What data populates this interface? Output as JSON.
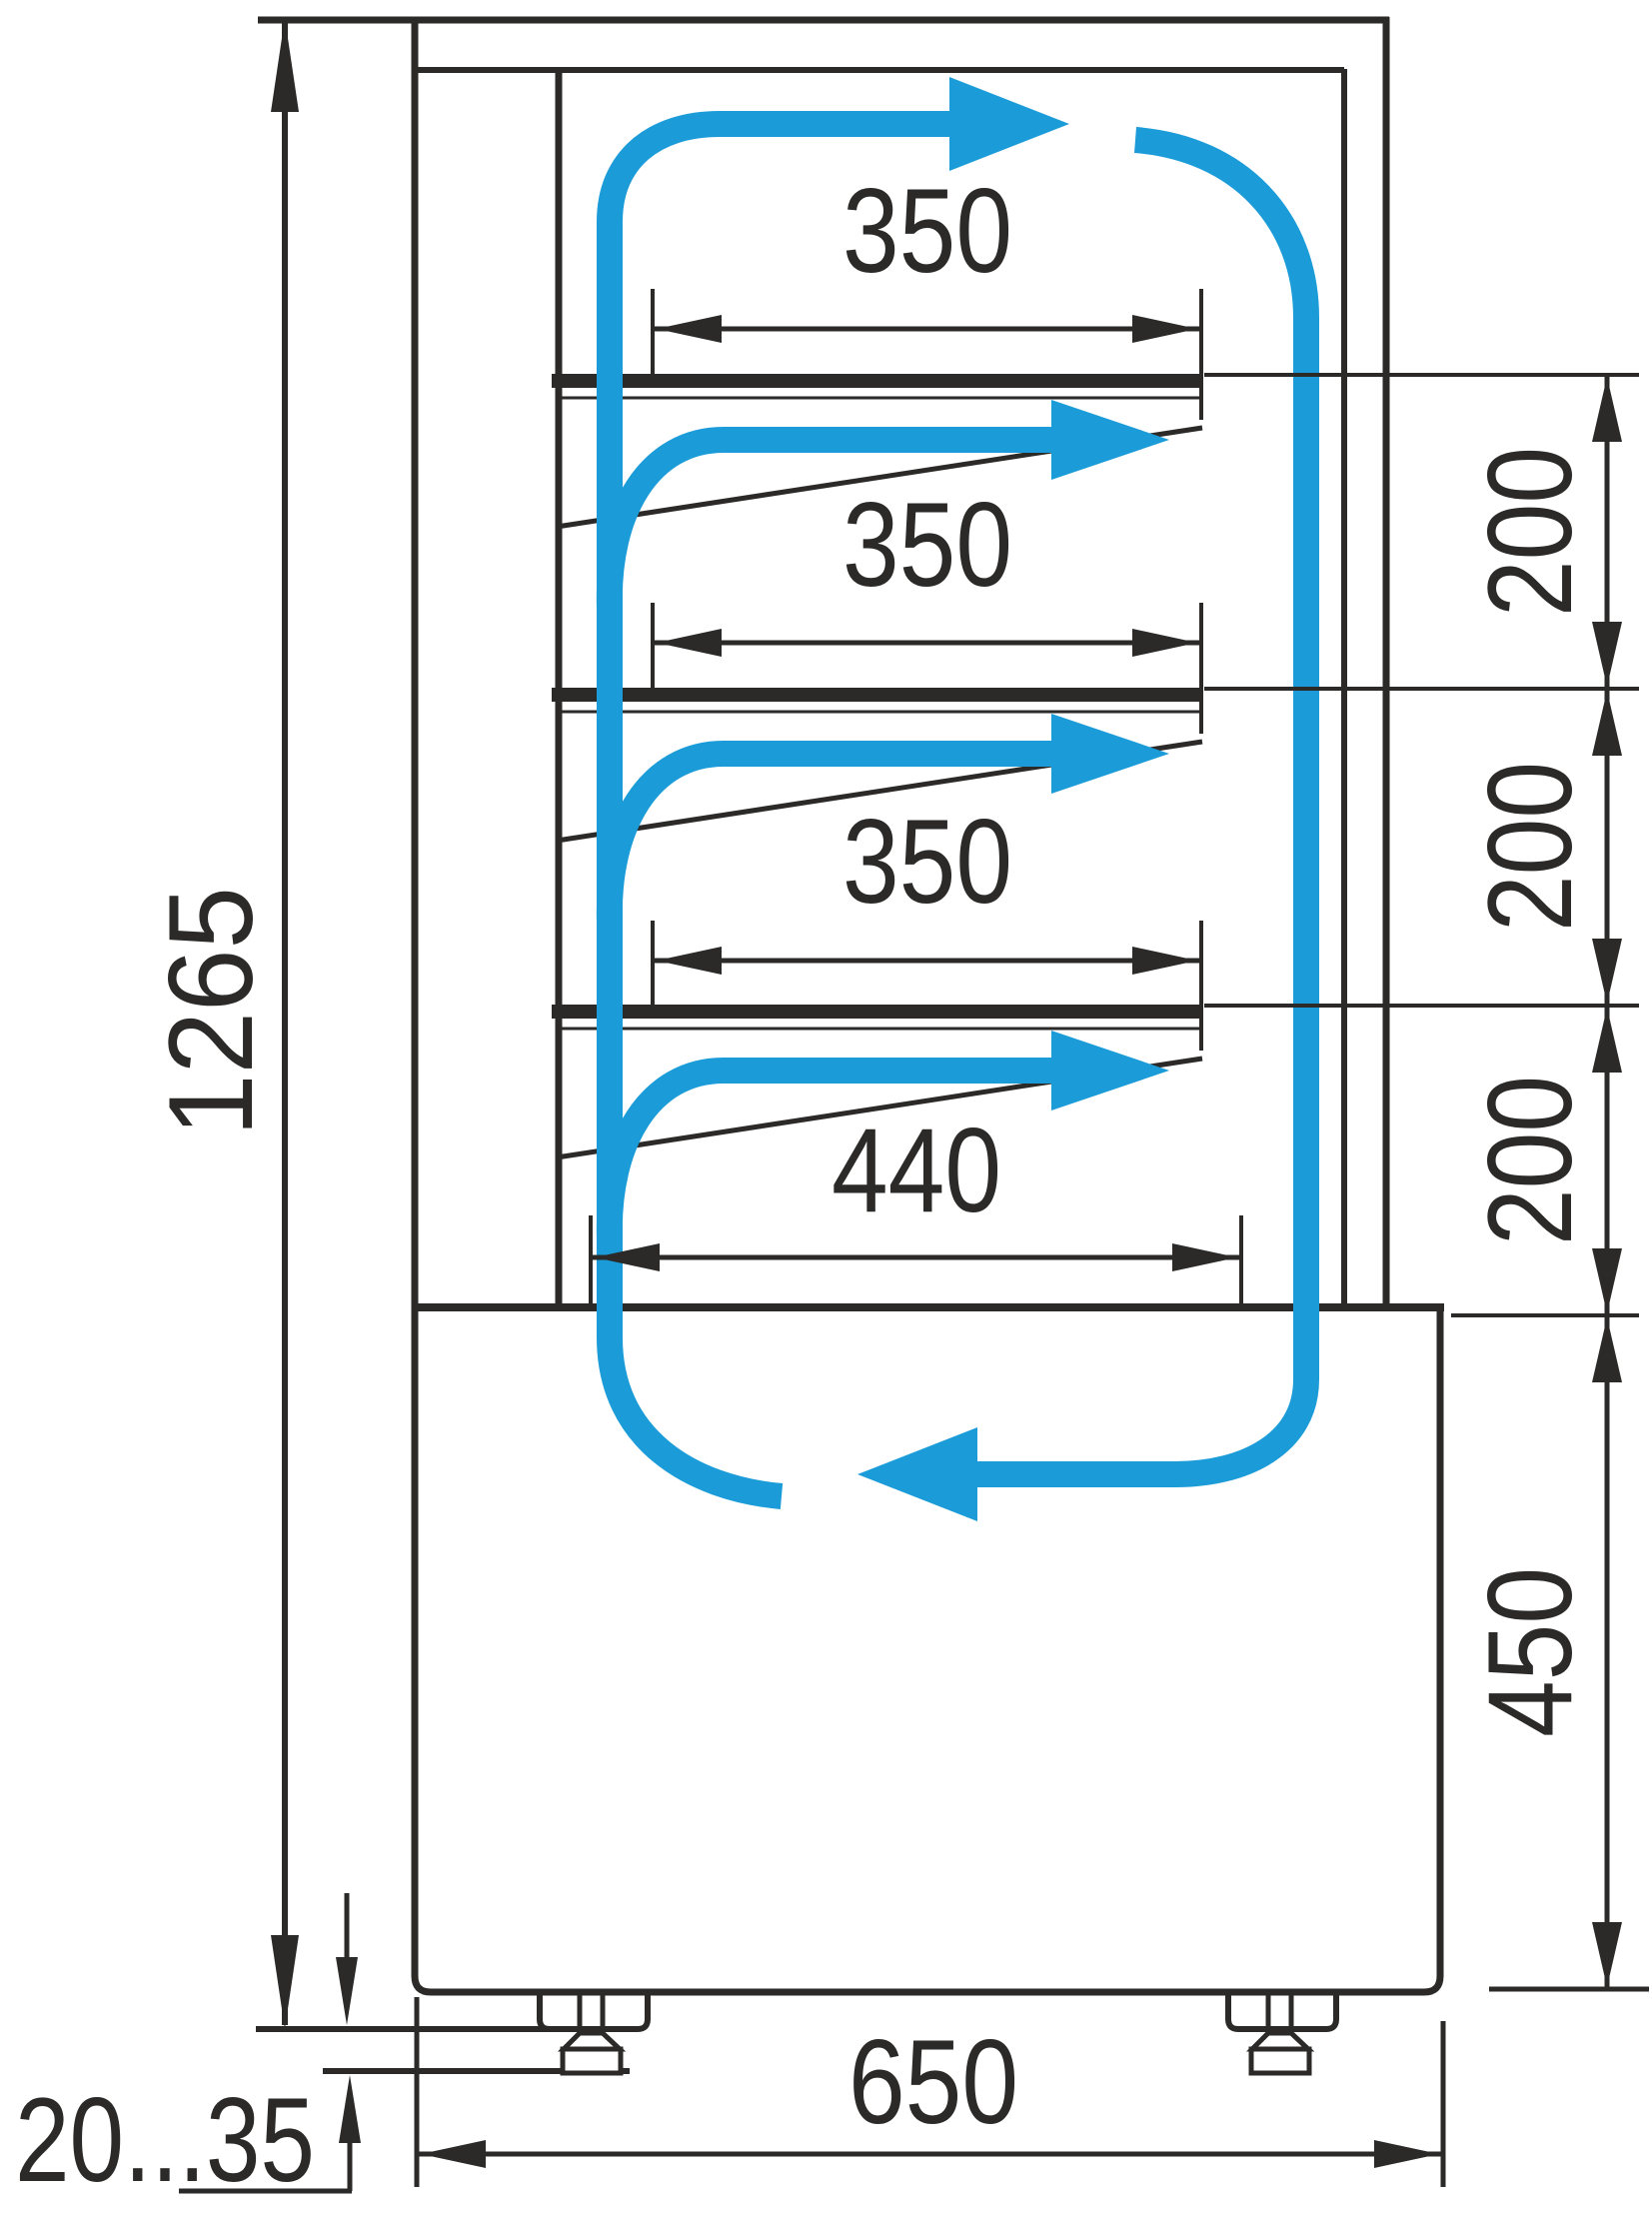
{
  "drawing": {
    "kind": "technical dimension drawing, side section of refrigerated display case with airflow circulation arrows",
    "colors": {
      "line": "#2b2a29",
      "airflow": "#1b9cd8",
      "background": "#ffffff"
    }
  },
  "labels": {
    "overall_height": "1265",
    "shelf_depth_1": "350",
    "shelf_depth_2": "350",
    "shelf_depth_3": "350",
    "bottom_shelf_depth": "440",
    "shelf_gap_1": "200",
    "shelf_gap_2": "200",
    "shelf_gap_3": "200",
    "base_height": "450",
    "overall_depth": "650",
    "foot_height_range": "20...35"
  }
}
